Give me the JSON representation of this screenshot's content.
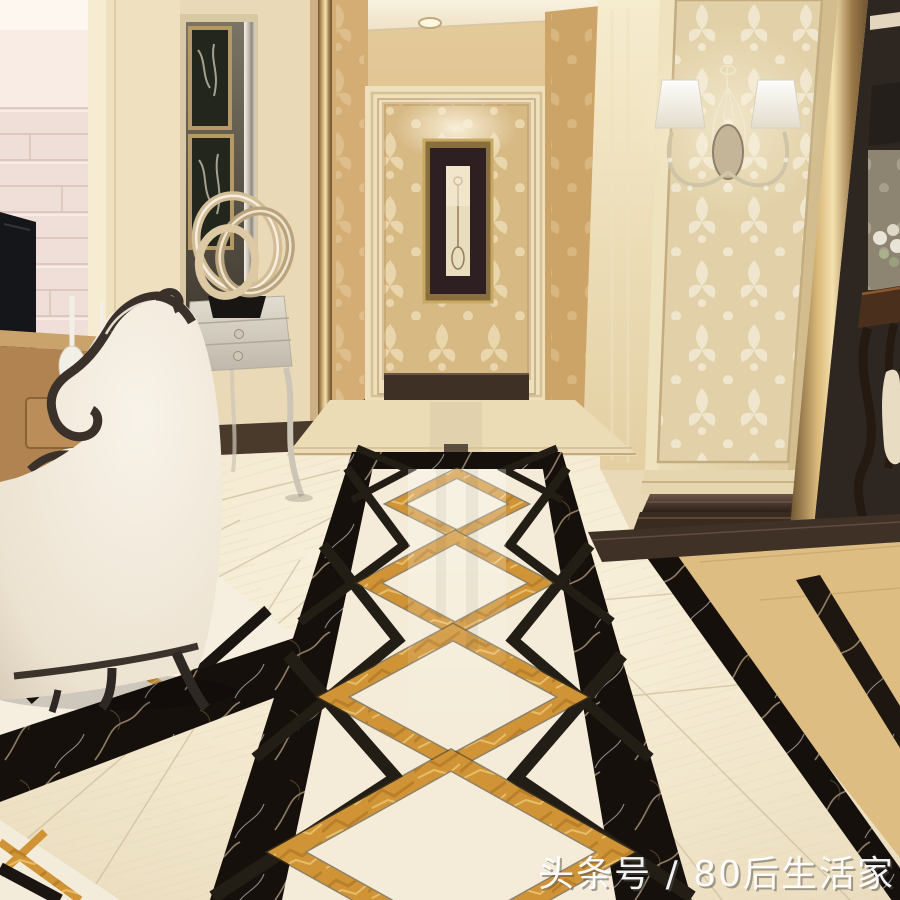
{
  "meta": {
    "domain": "Natural-Image",
    "description": "3D render of a luxury home entry hallway: polished marble floor walkway with black marble borders and gold diamond inlays, beige damask walls and column, crystal wall sconce, white wingback armchair, silver console with ring sculpture, framed etching in back alcove."
  },
  "watermark": {
    "text": "头条号 / 80后生活家",
    "color": "#ffffff"
  },
  "palette": {
    "wall_cream": "#e9d9b6",
    "wallpaper_gold": "#d7b984",
    "column_damask": "#e4d4ae",
    "marble_dark_base": "#3f3026",
    "black_marble": "#16100c",
    "gold_inlay": "#d09437",
    "floor_cream": "#f4ebd4",
    "dining_floor_gold": "#ddbd82",
    "wood_desk": "#b08350",
    "chair_cream": "#f0e9db",
    "chair_trim": "#3a322a",
    "console_silver": "#d6cfc2",
    "panel_pink": "#f0dfd8",
    "gold_trim_bar": "#d9b878"
  },
  "scene": {
    "objects": [
      "ceiling-downlights",
      "damask-back-wall",
      "alcove-artwork",
      "wall-sconce",
      "marble-column",
      "tv-wall-panel",
      "mirror-niche",
      "ring-sculpture",
      "console-table",
      "writing-desk",
      "white-floor-vases",
      "wingback-armchair",
      "marble-floor-walkway",
      "gold-diamond-inlays",
      "black-marble-borders",
      "dining-area-glimpse"
    ]
  }
}
